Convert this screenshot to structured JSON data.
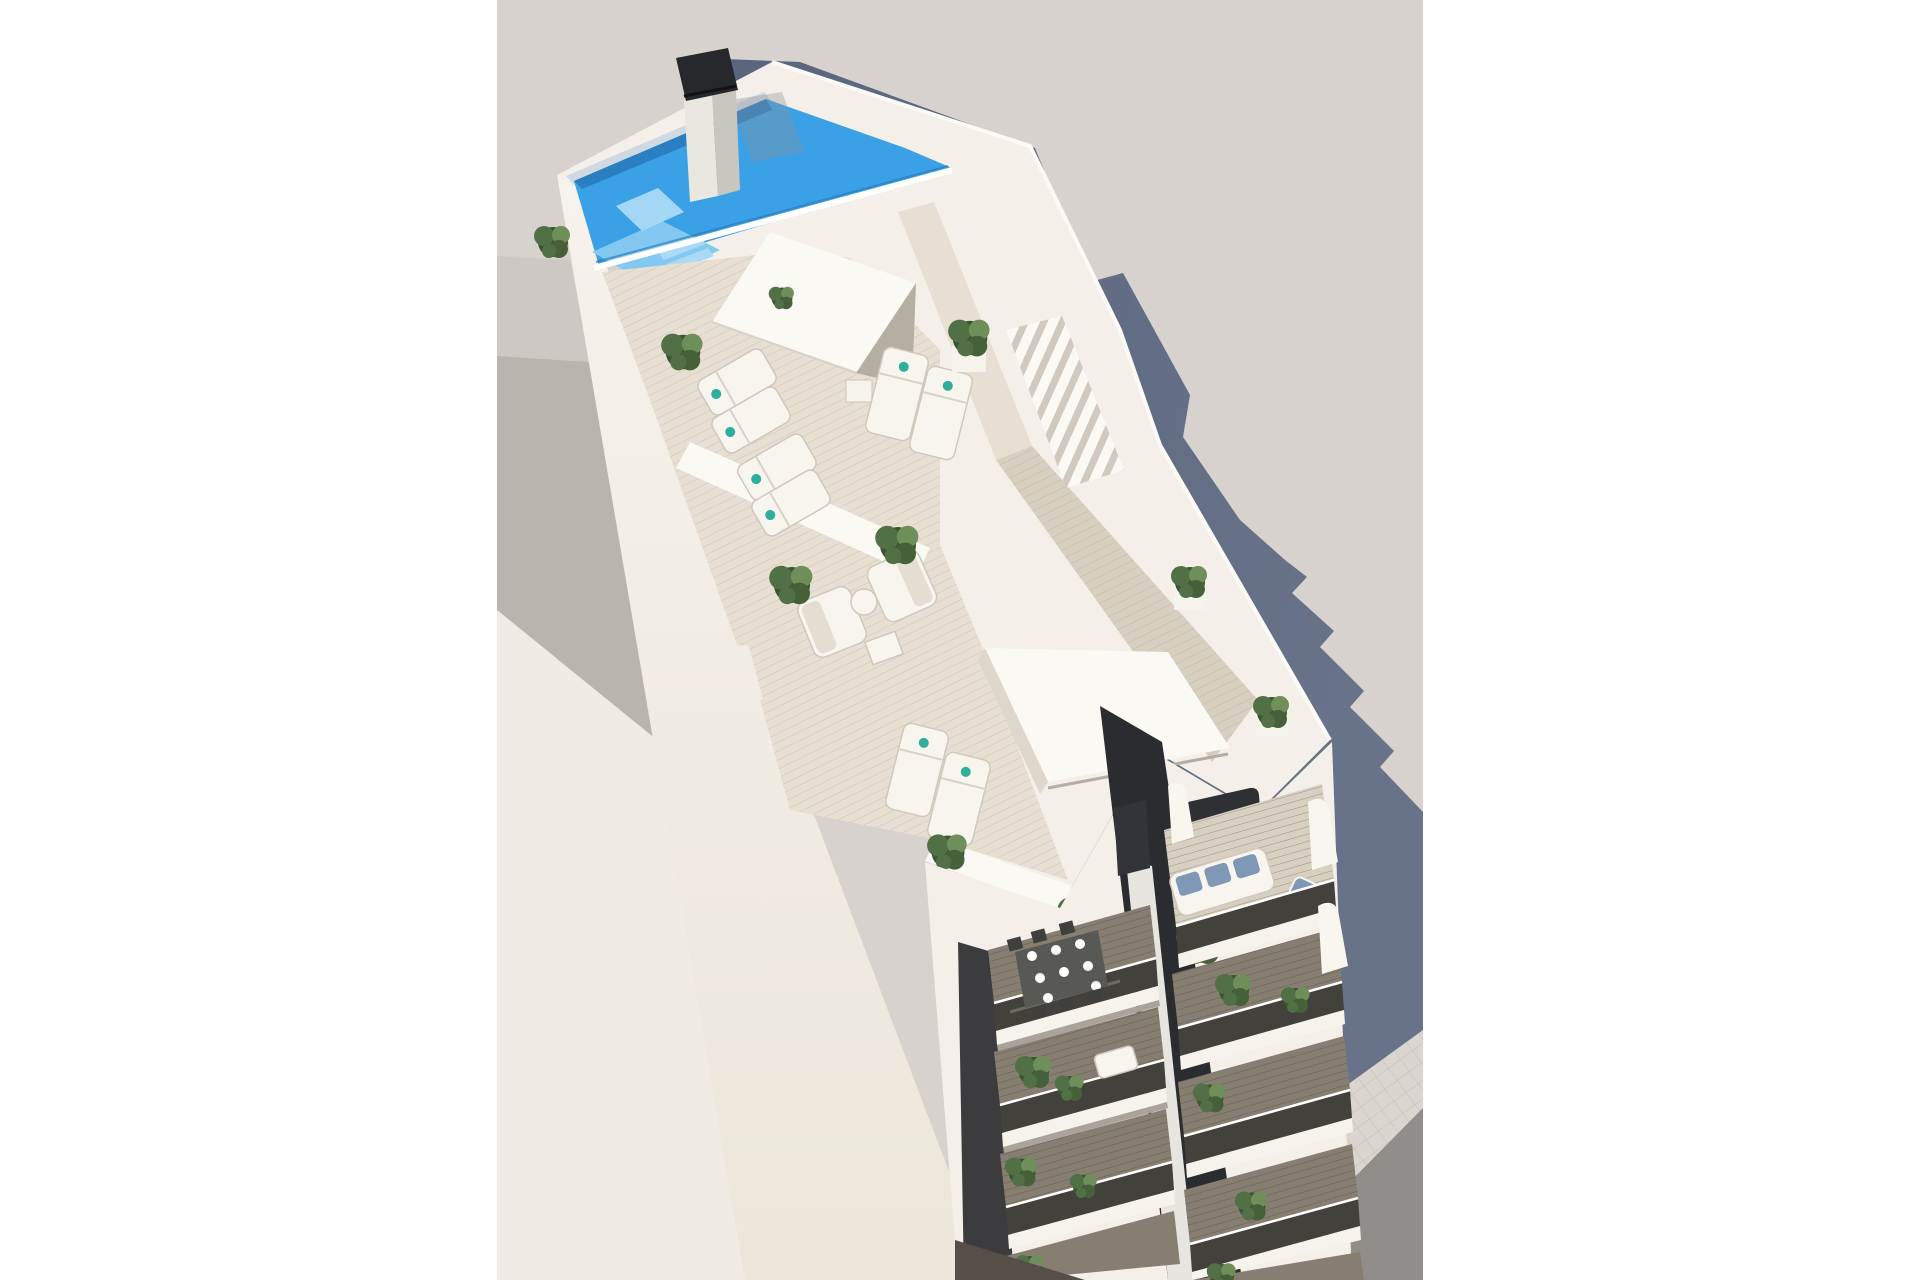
{
  "meta": {
    "type": "architectural-3d-render",
    "description": "Aerial 3D architectural rendering of a slim white apartment tower seen from above: rooftop swimming pool with tanning shelf and black-capped chimney, wood-deck roof terraces with sun loungers, lounge furniture, potted plants and pergola slats, two stacked columns of balconies with smoked-glass railings (dining set and blue-cushioned sofa visible), a large adjacent white building on the left, a stepped blue-grey shadow cast to the right, and a tiled sidewalk with dark road at the bottom right. White pillarbox margins on left and right.",
    "canvas": {
      "width": 1920,
      "height": 1280
    },
    "photo_region": {
      "x": 497,
      "y": 0,
      "width": 926,
      "height": 1280
    }
  },
  "palette": {
    "page_bg": "#ffffff",
    "backdrop": "#d7d2ce",
    "backdrop_far": "#cdc8c4",
    "adjacent_roof": "#b9b5ae",
    "adjacent_face": "#f1ece3",
    "shadow_cast": "#5d6980",
    "wall_light": "#f4f0e9",
    "wall_mid": "#eae5da",
    "wall_bright": "#fbf9f4",
    "parapet_shade": "#d6d0c6",
    "wood_light": "#e7e0d2",
    "wood_mid": "#d7cfc0",
    "pool_water": "#3ba1e6",
    "pool_deep": "#2779bb",
    "pool_shelf": "#82c8f0",
    "pool_steps": "#aadaf6",
    "pool_wall": "#cfd9e1",
    "chimney_cap": "#26282c",
    "chimney_body": "#eae7e1",
    "chimney_side": "#c9c6c0",
    "railing_black": "#1e1e1e",
    "plant_dark": "#3c5430",
    "plant_mid": "#527046",
    "plant_light": "#6e8f5a",
    "planter": "#f6f3ed",
    "glass_dark": "#43413b",
    "glass_streak": "#8d867a",
    "balcony_floor": "#867e70",
    "fascia": "#f6f3ed",
    "fascia_shadow": "#a9a399",
    "recess_dark": "#2b2c2f",
    "table_dark": "#585955",
    "furniture_white": "#f8f5ef",
    "furniture_frame": "#cfc8bb",
    "sofa_blue": "#7e98b6",
    "towel_teal": "#2fae9e",
    "sidewalk": "#dad6cf",
    "sidewalk_line": "#c6c1b9",
    "road": "#908d8a",
    "ground_shadow": "#6b7180",
    "ground_dark": "#564f47"
  },
  "scene": {
    "setting": "daytime, strong sunlight from upper left",
    "elements": [
      {
        "name": "main-building",
        "label": "White residential tower viewed from above at an angle"
      },
      {
        "name": "rooftop-pool",
        "label": "Bright blue swimming pool with tanning shelf, steps and seating platform"
      },
      {
        "name": "chimney",
        "label": "Rooftop chimney stack with dark charcoal cap"
      },
      {
        "name": "roof-terrace",
        "label": "Wood-deck rooftop solarium with sun loungers and planters"
      },
      {
        "name": "stair-railing",
        "label": "Black metal railing around rooftop stair opening"
      },
      {
        "name": "core-boxes",
        "label": "Two white rooftop stair/elevator bulkheads",
        "count": 2
      },
      {
        "name": "pergola-slats",
        "label": "White sunshade slats along the east parapet"
      },
      {
        "name": "lounge-courtyard",
        "label": "Recessed terrace with white lounge armchairs and coffee tables"
      },
      {
        "name": "sun-loungers",
        "label": "White sun loungers with teal towels",
        "count": 8
      },
      {
        "name": "planters",
        "label": "Green shrubs in white planters",
        "count": 18
      },
      {
        "name": "balcony-column-left",
        "label": "Stacked balconies with smoked glass railings, dining set with plates on top floor",
        "floors_visible": 4
      },
      {
        "name": "balcony-column-right",
        "label": "Stacked balconies, top terrace with white sofa and blue cushions",
        "floors_visible": 5
      },
      {
        "name": "dining-set",
        "label": "Dark outdoor dining table, 6 chairs, 8 place settings"
      },
      {
        "name": "adjacent-building",
        "label": "Large neighbouring white building with grey roof planes, lower left"
      },
      {
        "name": "cast-shadow",
        "label": "Stepped blue-grey building shadow on backdrop, right side"
      },
      {
        "name": "sidewalk",
        "label": "Light tiled sidewalk band, bottom right"
      },
      {
        "name": "road",
        "label": "Dark asphalt road, bottom right corner"
      }
    ]
  }
}
